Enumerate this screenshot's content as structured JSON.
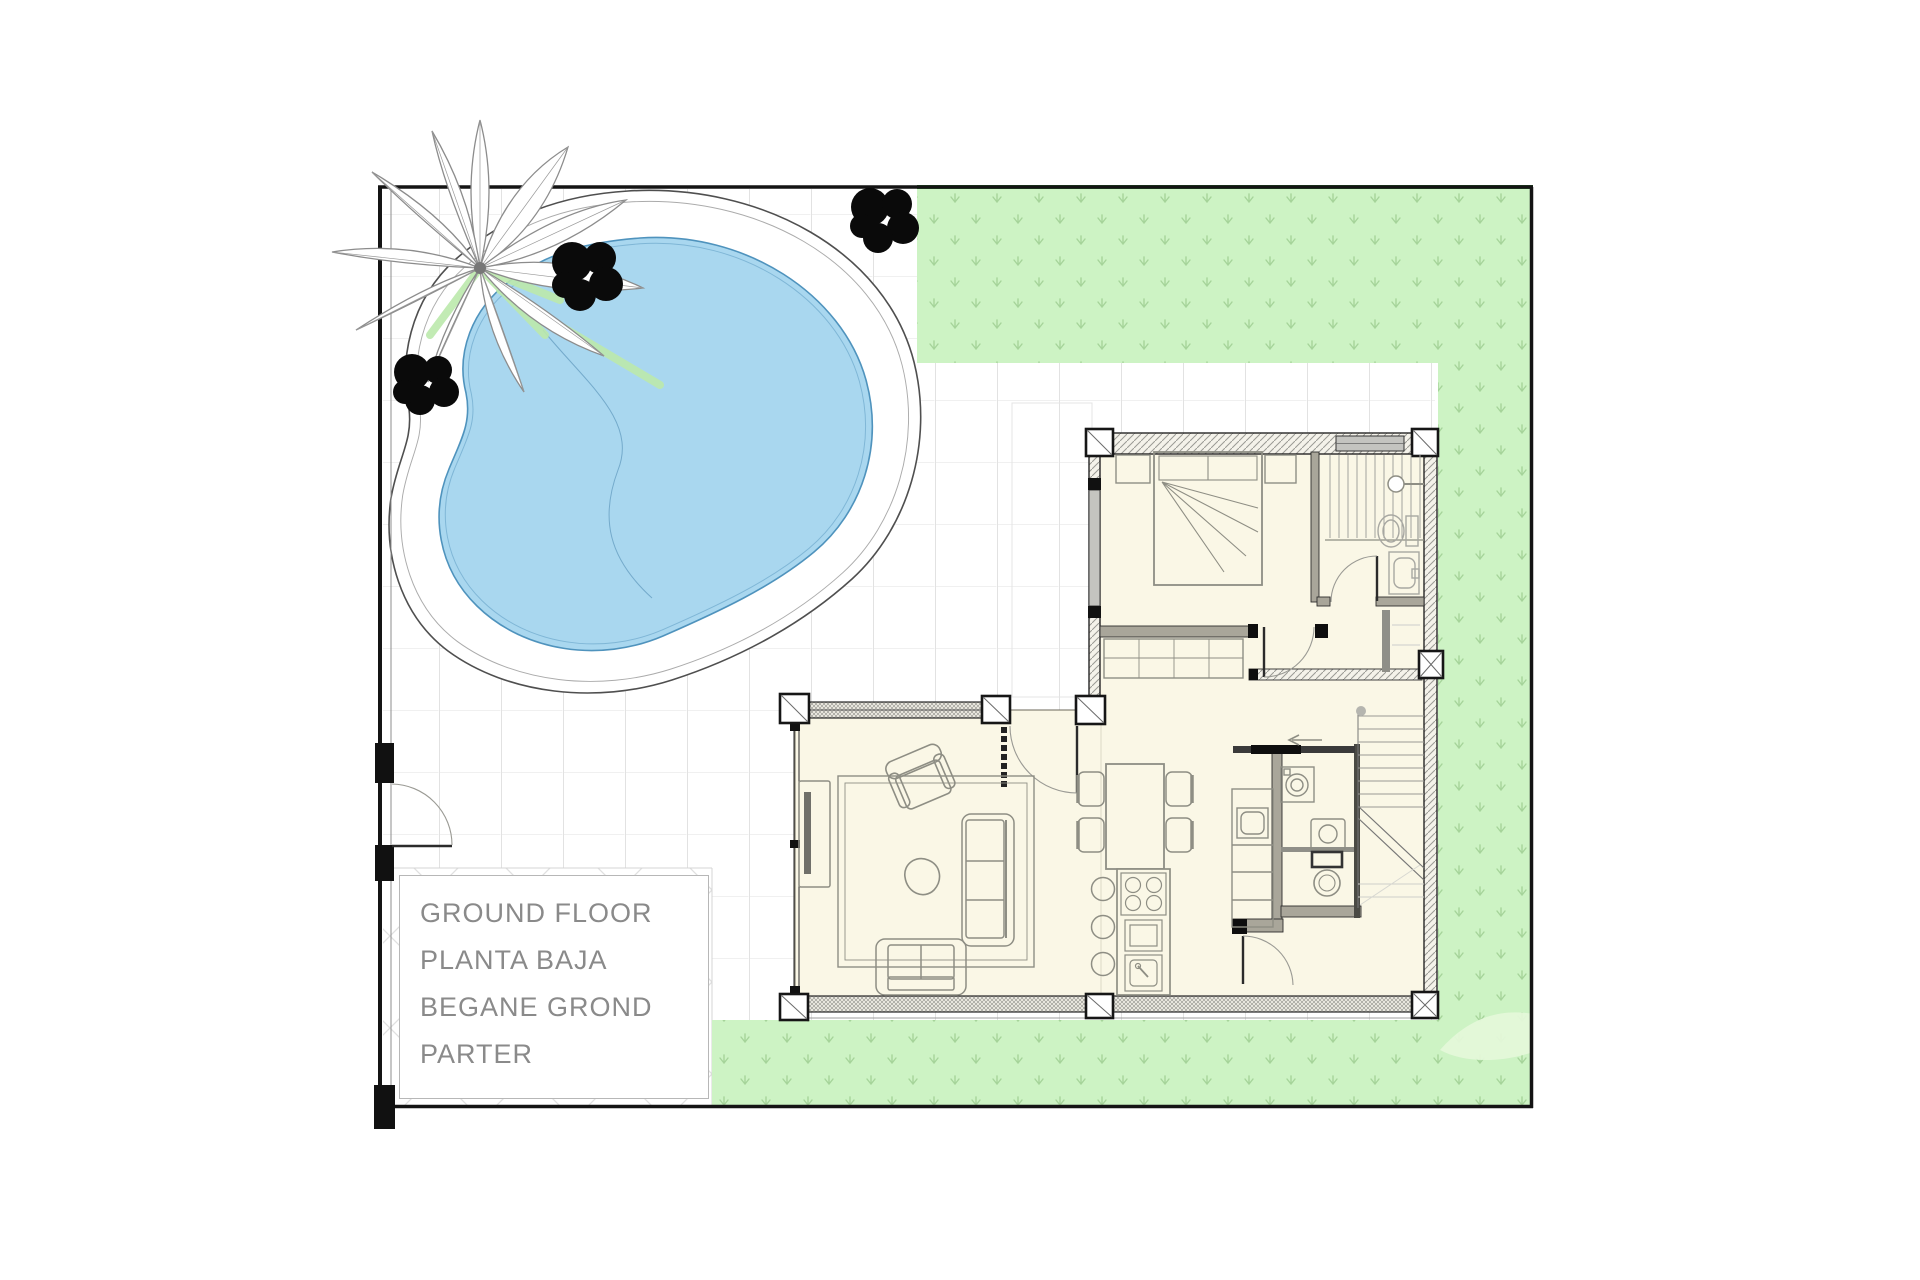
{
  "title_block": {
    "lines": [
      "GROUND FLOOR",
      "PLANTA BAJA",
      "BEGANE GROND",
      "PARTER"
    ]
  },
  "colors": {
    "pool_water": "#a9d7ef",
    "pool_edge": "#4f93bd",
    "lawn": "#cdf3c4",
    "lawn_mark": "#a6d49a",
    "lawn_dark_edge": "#2e7c2e",
    "floor": "#faf7e6",
    "wall_dark": "#222222",
    "interior_wall": "#a9a69a",
    "furniture_line": "#8e8e84",
    "fixture_line": "#a8a8a2",
    "grid_line": "#e2e2e2",
    "text_gray": "#8a8a8a",
    "border_black": "#141414",
    "glass_gray": "#c4c4c0"
  }
}
